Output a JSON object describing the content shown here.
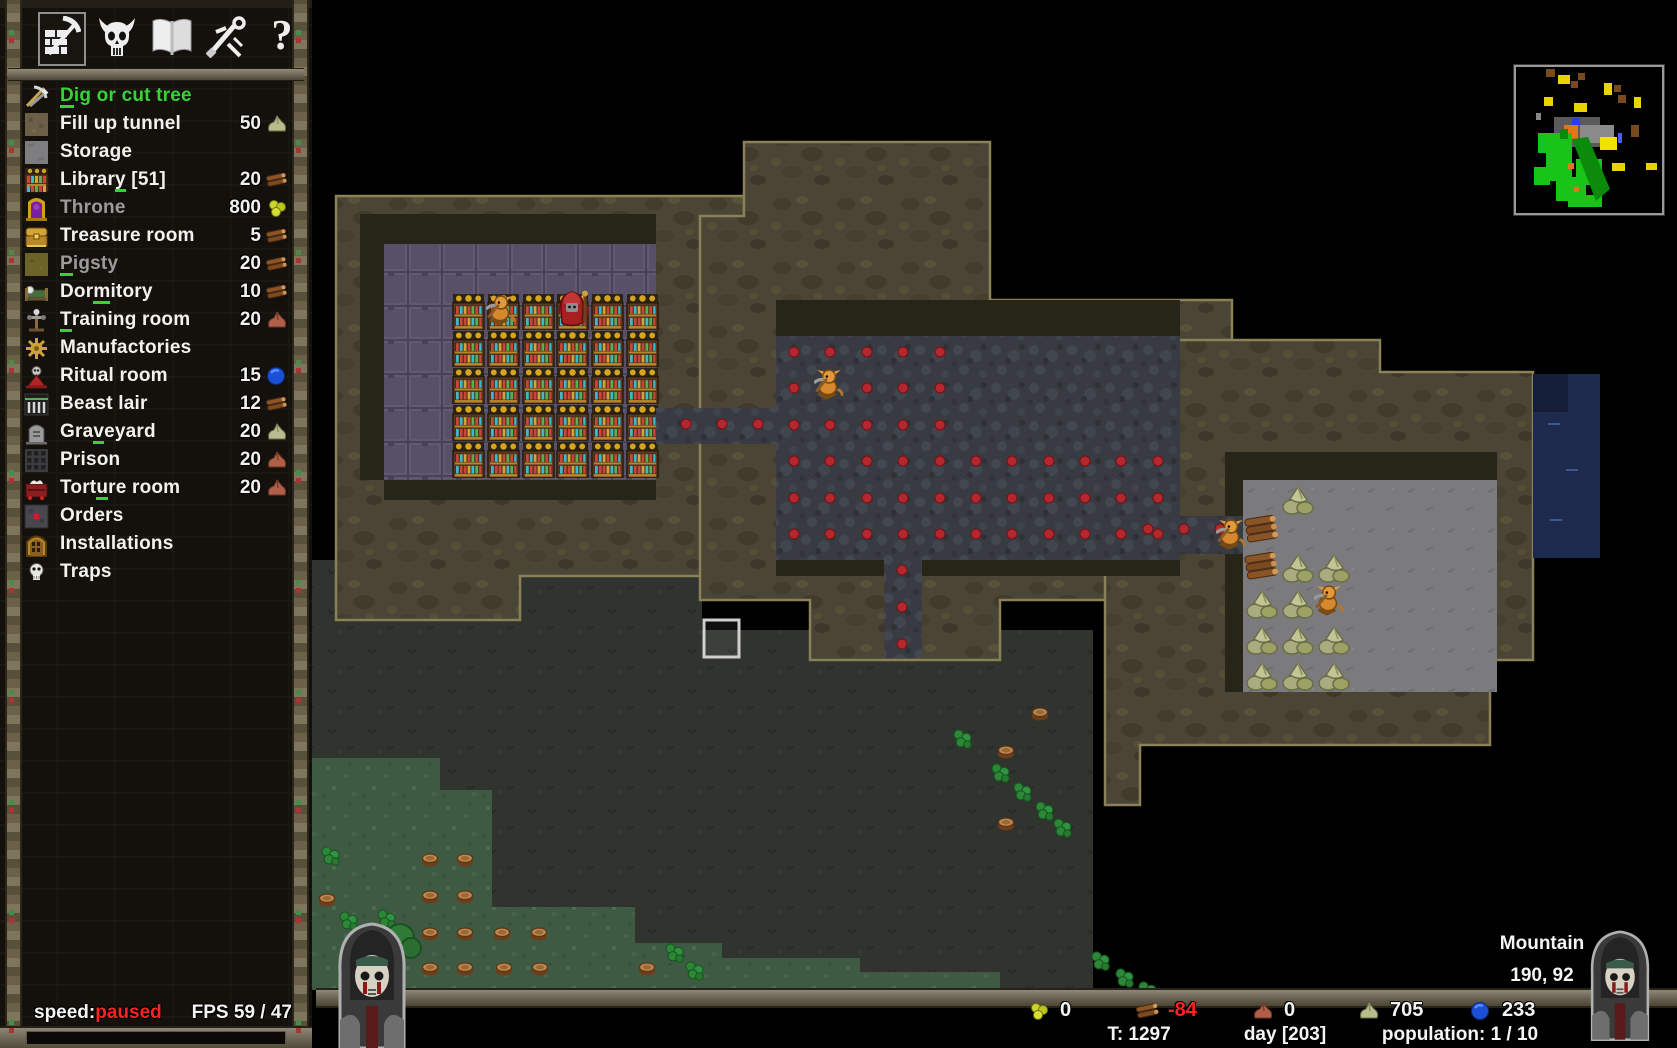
{
  "toolbar": {
    "tabs": [
      {
        "name": "build",
        "icon": "pickaxe-wall-icon",
        "selected": true
      },
      {
        "name": "minions",
        "icon": "horned-skull-icon",
        "selected": false
      },
      {
        "name": "technology",
        "icon": "book-icon",
        "selected": false
      },
      {
        "name": "combat",
        "icon": "sword-icon",
        "selected": false
      },
      {
        "name": "help",
        "icon": "question-icon",
        "selected": false
      }
    ]
  },
  "build_menu": {
    "items": [
      {
        "label_pre": "",
        "label_key": "D",
        "label_post": "ig or cut tree",
        "icon": "dig-icon",
        "state": "active",
        "cost": "",
        "cost_icon": ""
      },
      {
        "label_pre": "Fill up tunnel",
        "label_key": "",
        "label_post": "",
        "icon": "tunnel-icon",
        "state": "normal",
        "cost": "50",
        "cost_icon": "stone"
      },
      {
        "label_pre": "Storage",
        "label_key": "",
        "label_post": "",
        "icon": "storage-icon",
        "state": "normal",
        "cost": "",
        "cost_icon": ""
      },
      {
        "label_pre": "Librar",
        "label_key": "y",
        "label_post": " [51]",
        "icon": "library-icon",
        "state": "normal",
        "cost": "20",
        "cost_icon": "wood"
      },
      {
        "label_pre": "Throne",
        "label_key": "",
        "label_post": "",
        "icon": "throne-icon",
        "state": "disabled",
        "cost": "800",
        "cost_icon": "gold"
      },
      {
        "label_pre": "Treasure room",
        "label_key": "",
        "label_post": "",
        "icon": "treasure-icon",
        "state": "normal",
        "cost": "5",
        "cost_icon": "wood"
      },
      {
        "label_pre": "",
        "label_key": "P",
        "label_post": "igsty",
        "icon": "pigsty-icon",
        "state": "disabled",
        "cost": "20",
        "cost_icon": "wood"
      },
      {
        "label_pre": "Dor",
        "label_key": "m",
        "label_post": "itory",
        "icon": "dormitory-icon",
        "state": "normal",
        "cost": "10",
        "cost_icon": "wood"
      },
      {
        "label_pre": "",
        "label_key": "T",
        "label_post": "raining room",
        "icon": "training-icon",
        "state": "normal",
        "cost": "20",
        "cost_icon": "iron"
      },
      {
        "label_pre": "Manufactories",
        "label_key": "",
        "label_post": "",
        "icon": "manufactory-icon",
        "state": "normal",
        "cost": "",
        "cost_icon": ""
      },
      {
        "label_pre": "Ritual room",
        "label_key": "",
        "label_post": "",
        "icon": "ritual-icon",
        "state": "normal",
        "cost": "15",
        "cost_icon": "mana"
      },
      {
        "label_pre": "Beast lair",
        "label_key": "",
        "label_post": "",
        "icon": "beast-lair-icon",
        "state": "normal",
        "cost": "12",
        "cost_icon": "wood"
      },
      {
        "label_pre": "Gra",
        "label_key": "v",
        "label_post": "eyard",
        "icon": "graveyard-icon",
        "state": "normal",
        "cost": "20",
        "cost_icon": "stone"
      },
      {
        "label_pre": "Prison",
        "label_key": "",
        "label_post": "",
        "icon": "prison-icon",
        "state": "normal",
        "cost": "20",
        "cost_icon": "iron"
      },
      {
        "label_pre": "Tort",
        "label_key": "u",
        "label_post": "re room",
        "icon": "torture-icon",
        "state": "normal",
        "cost": "20",
        "cost_icon": "iron"
      },
      {
        "label_pre": "Orders",
        "label_key": "",
        "label_post": "",
        "icon": "orders-icon",
        "state": "normal",
        "cost": "",
        "cost_icon": ""
      },
      {
        "label_pre": "Installations",
        "label_key": "",
        "label_post": "",
        "icon": "installations-icon",
        "state": "normal",
        "cost": "",
        "cost_icon": ""
      },
      {
        "label_pre": "Traps",
        "label_key": "",
        "label_post": "",
        "icon": "traps-icon",
        "state": "normal",
        "cost": "",
        "cost_icon": ""
      }
    ]
  },
  "status_bar": {
    "speed_label": "speed:",
    "speed_value": "paused",
    "fps": "FPS 59 / 47"
  },
  "resources": [
    {
      "icon": "gold",
      "value": "0",
      "negative": false
    },
    {
      "icon": "wood",
      "value": "-84",
      "negative": true
    },
    {
      "icon": "iron",
      "value": "0",
      "negative": false
    },
    {
      "icon": "stone",
      "value": "705",
      "negative": false
    },
    {
      "icon": "mana",
      "value": "233",
      "negative": false
    }
  ],
  "game_stats": {
    "turn": "T: 1297",
    "day": "day [203]",
    "population": "population: 1 / 10"
  },
  "tile_info": {
    "terrain": "Mountain",
    "coords": "190, 92"
  },
  "colors": {
    "accent_green": "#35d435",
    "warning_red": "#ff2222",
    "disabled_gray": "#9b9b9b"
  }
}
